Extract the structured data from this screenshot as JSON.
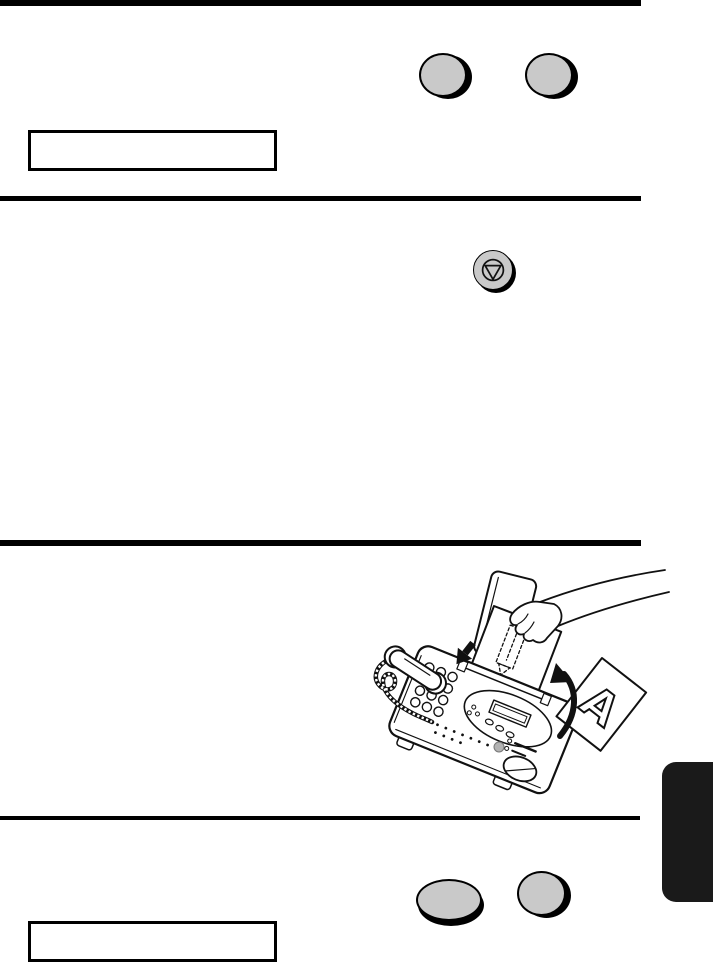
{
  "document": {
    "type": "fax machine manual page (text stripped)",
    "letter_on_output_sheet": "A",
    "display_box_top_text": "",
    "display_box_bottom_text": ""
  },
  "colors": {
    "background": "#ffffff",
    "line": "#000000",
    "key_gray": "#c9c9c9",
    "side_tab": "#1a1a1a"
  },
  "icons": {
    "stop_key_icon": "stop-icon (circle with inverted triangle)",
    "feed_arrow": "solid arrow pointing down-left into feeder",
    "flip_arrow": "curved arrow pointing up"
  }
}
